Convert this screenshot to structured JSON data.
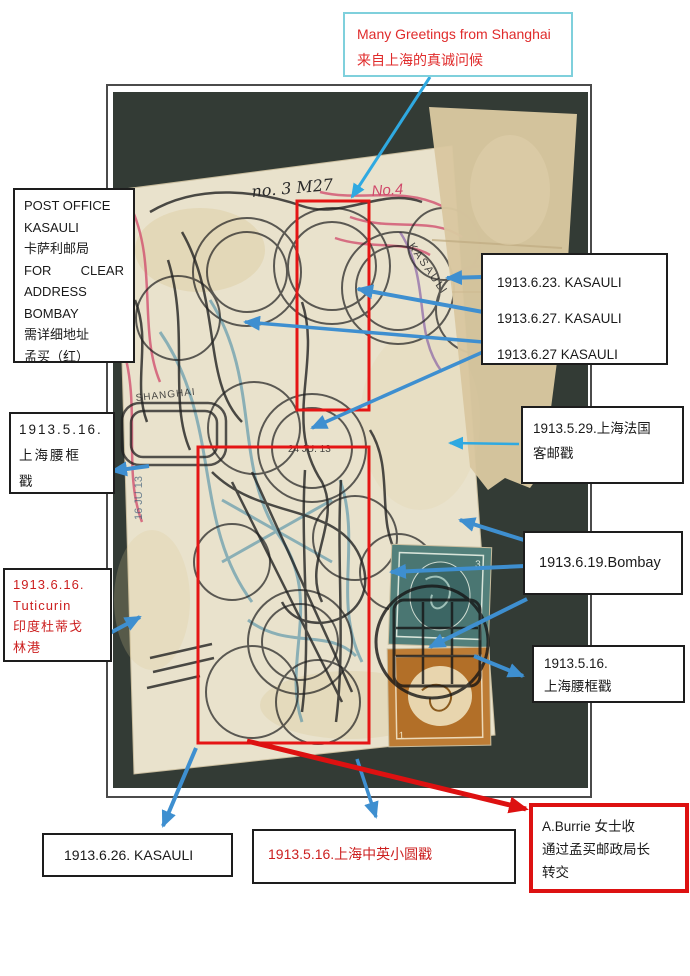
{
  "document": {
    "type": "annotated postcard exhibit page",
    "colors": {
      "arrow_blue": "#3e8fd0",
      "arrow_cyan": "#2fa9e1",
      "highlight_red": "#e51515",
      "greeting_border_teal": "#7fd0dc",
      "red_text": "#cc1f1f",
      "photo_background": "#333b35",
      "postcard_cream": "#e9e2cc",
      "tape_tan": "#d9c7a0",
      "stamp_green": "#53807b",
      "stamp_orange": "#bd7c35"
    }
  },
  "labels": {
    "greeting": {
      "en": "Many Greetings from Shanghai",
      "zh": "来自上海的真诚问候"
    },
    "post_office": {
      "l1": "POST OFFICE",
      "l2": "KASAULI",
      "l3": "卡萨利邮局",
      "l4a": "FOR",
      "l4b": "CLEAR",
      "l5": "ADDRESS",
      "l6": "BOMBAY",
      "l7": "需详细地址",
      "l8": "孟买（红）"
    },
    "kasauli_dates": {
      "d1": "1913.6.23. KASAULI",
      "d2": "1913.6.27. KASAULI",
      "d3": "1913.6.27 KASAULI"
    },
    "shanghai_french": {
      "l1": "1913.5.29.上海法国",
      "l2": "客邮戳"
    },
    "bombay": {
      "l1": "1913.6.19.Bombay"
    },
    "waist_frame_right": {
      "l1": "1913.5.16.",
      "l2": "上海腰框戳"
    },
    "waist_frame_left": {
      "l1": "1913.5.16.",
      "l2": "上海腰框",
      "l3": "戳"
    },
    "tuticurin": {
      "l1": "1913.6.16.",
      "l2": "Tuticurin",
      "l3": "印度杜蒂戈",
      "l4": "林港"
    },
    "kasauli_bottom": {
      "l1": "1913.6.26. KASAULI"
    },
    "small_circle_cancel": {
      "l1": "1913.5.16.上海中英小圆戳"
    },
    "aburrie": {
      "l1": "A.Burrie 女士收",
      "l2": "通过孟买邮政局长",
      "l3": "转交"
    }
  },
  "postcard_marks": {
    "handwriting_top": "no. 3 M27",
    "handwriting_no4": "No.4",
    "postmark_kasauli": "KASAULI",
    "postmark_shanghai": "SHANGHAI",
    "postmark_date_1": "24 JU. 13",
    "postmark_date_2": "16 JU 13",
    "stamp_green_value": "3",
    "stamp_orange_value": "1"
  }
}
